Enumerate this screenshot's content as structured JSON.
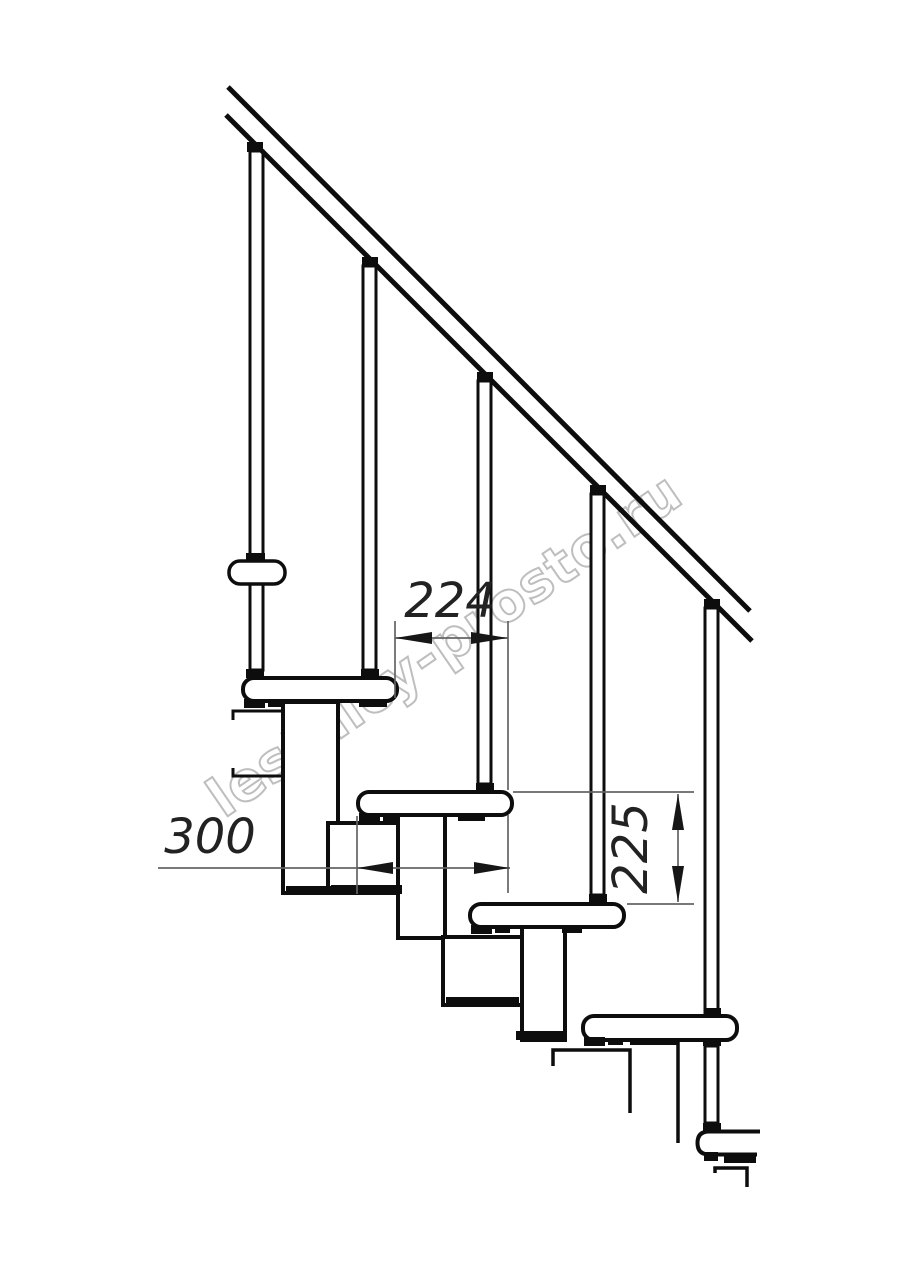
{
  "drawing": {
    "watermark": "lestnicy-prosto.ru",
    "dimensions": {
      "going": "224",
      "tread_depth": "300",
      "rise": "225"
    },
    "colors": {
      "background": "#ffffff",
      "line": "#0d0d0d",
      "dimension_line": "#646464",
      "dimension_text": "#222222",
      "watermark_outline": "#b3b3b3"
    },
    "counts": {
      "treads": 5,
      "balusters": 5
    }
  }
}
